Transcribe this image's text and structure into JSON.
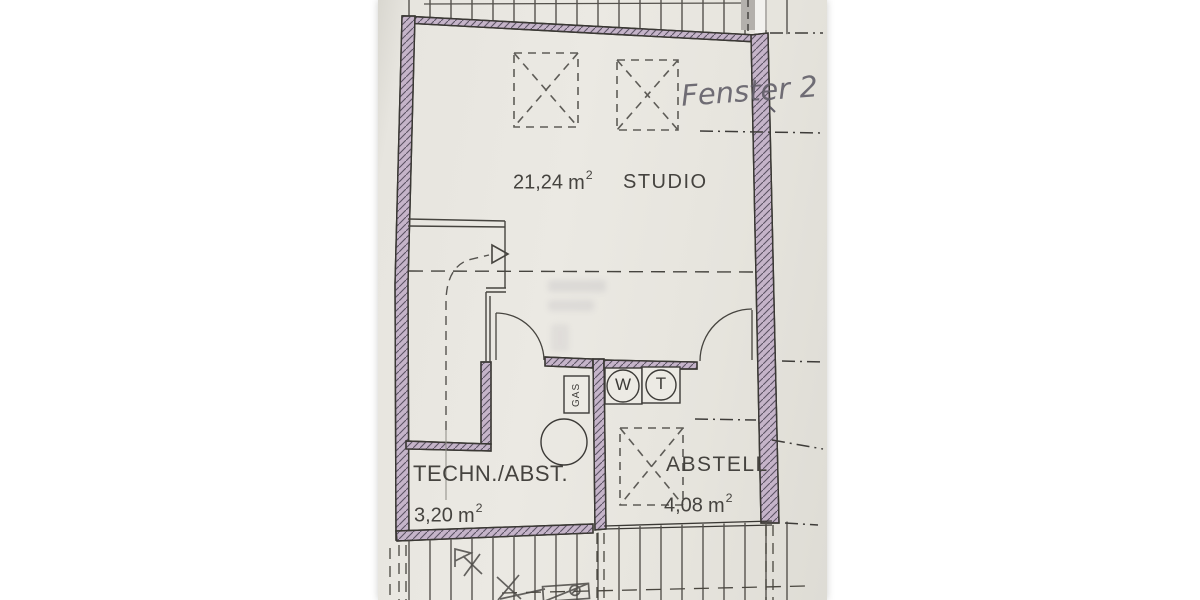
{
  "plan": {
    "kind": "floor-plan scan",
    "rooms": [
      {
        "name": "STUDIO",
        "area": "21,24",
        "area_unit": "m",
        "area_exp": "2"
      },
      {
        "name": "TECHN./ABST.",
        "area": "3,20",
        "area_unit": "m",
        "area_exp": "2"
      },
      {
        "name": "ABSTELL",
        "area": "4,08",
        "area_unit": "m",
        "area_exp": "2"
      }
    ],
    "handwriting": {
      "text": "Fenster 2"
    },
    "symbols": {
      "washer": "W",
      "dryer": "T",
      "gas": "GAS"
    },
    "colors": {
      "paper": "#e7e5df",
      "wall_fill": "#c5b4c9",
      "wall_hatch": "#5b5363",
      "print_line": "#46443f",
      "pencil": "#5f5c66",
      "background": "#ffffff"
    }
  }
}
